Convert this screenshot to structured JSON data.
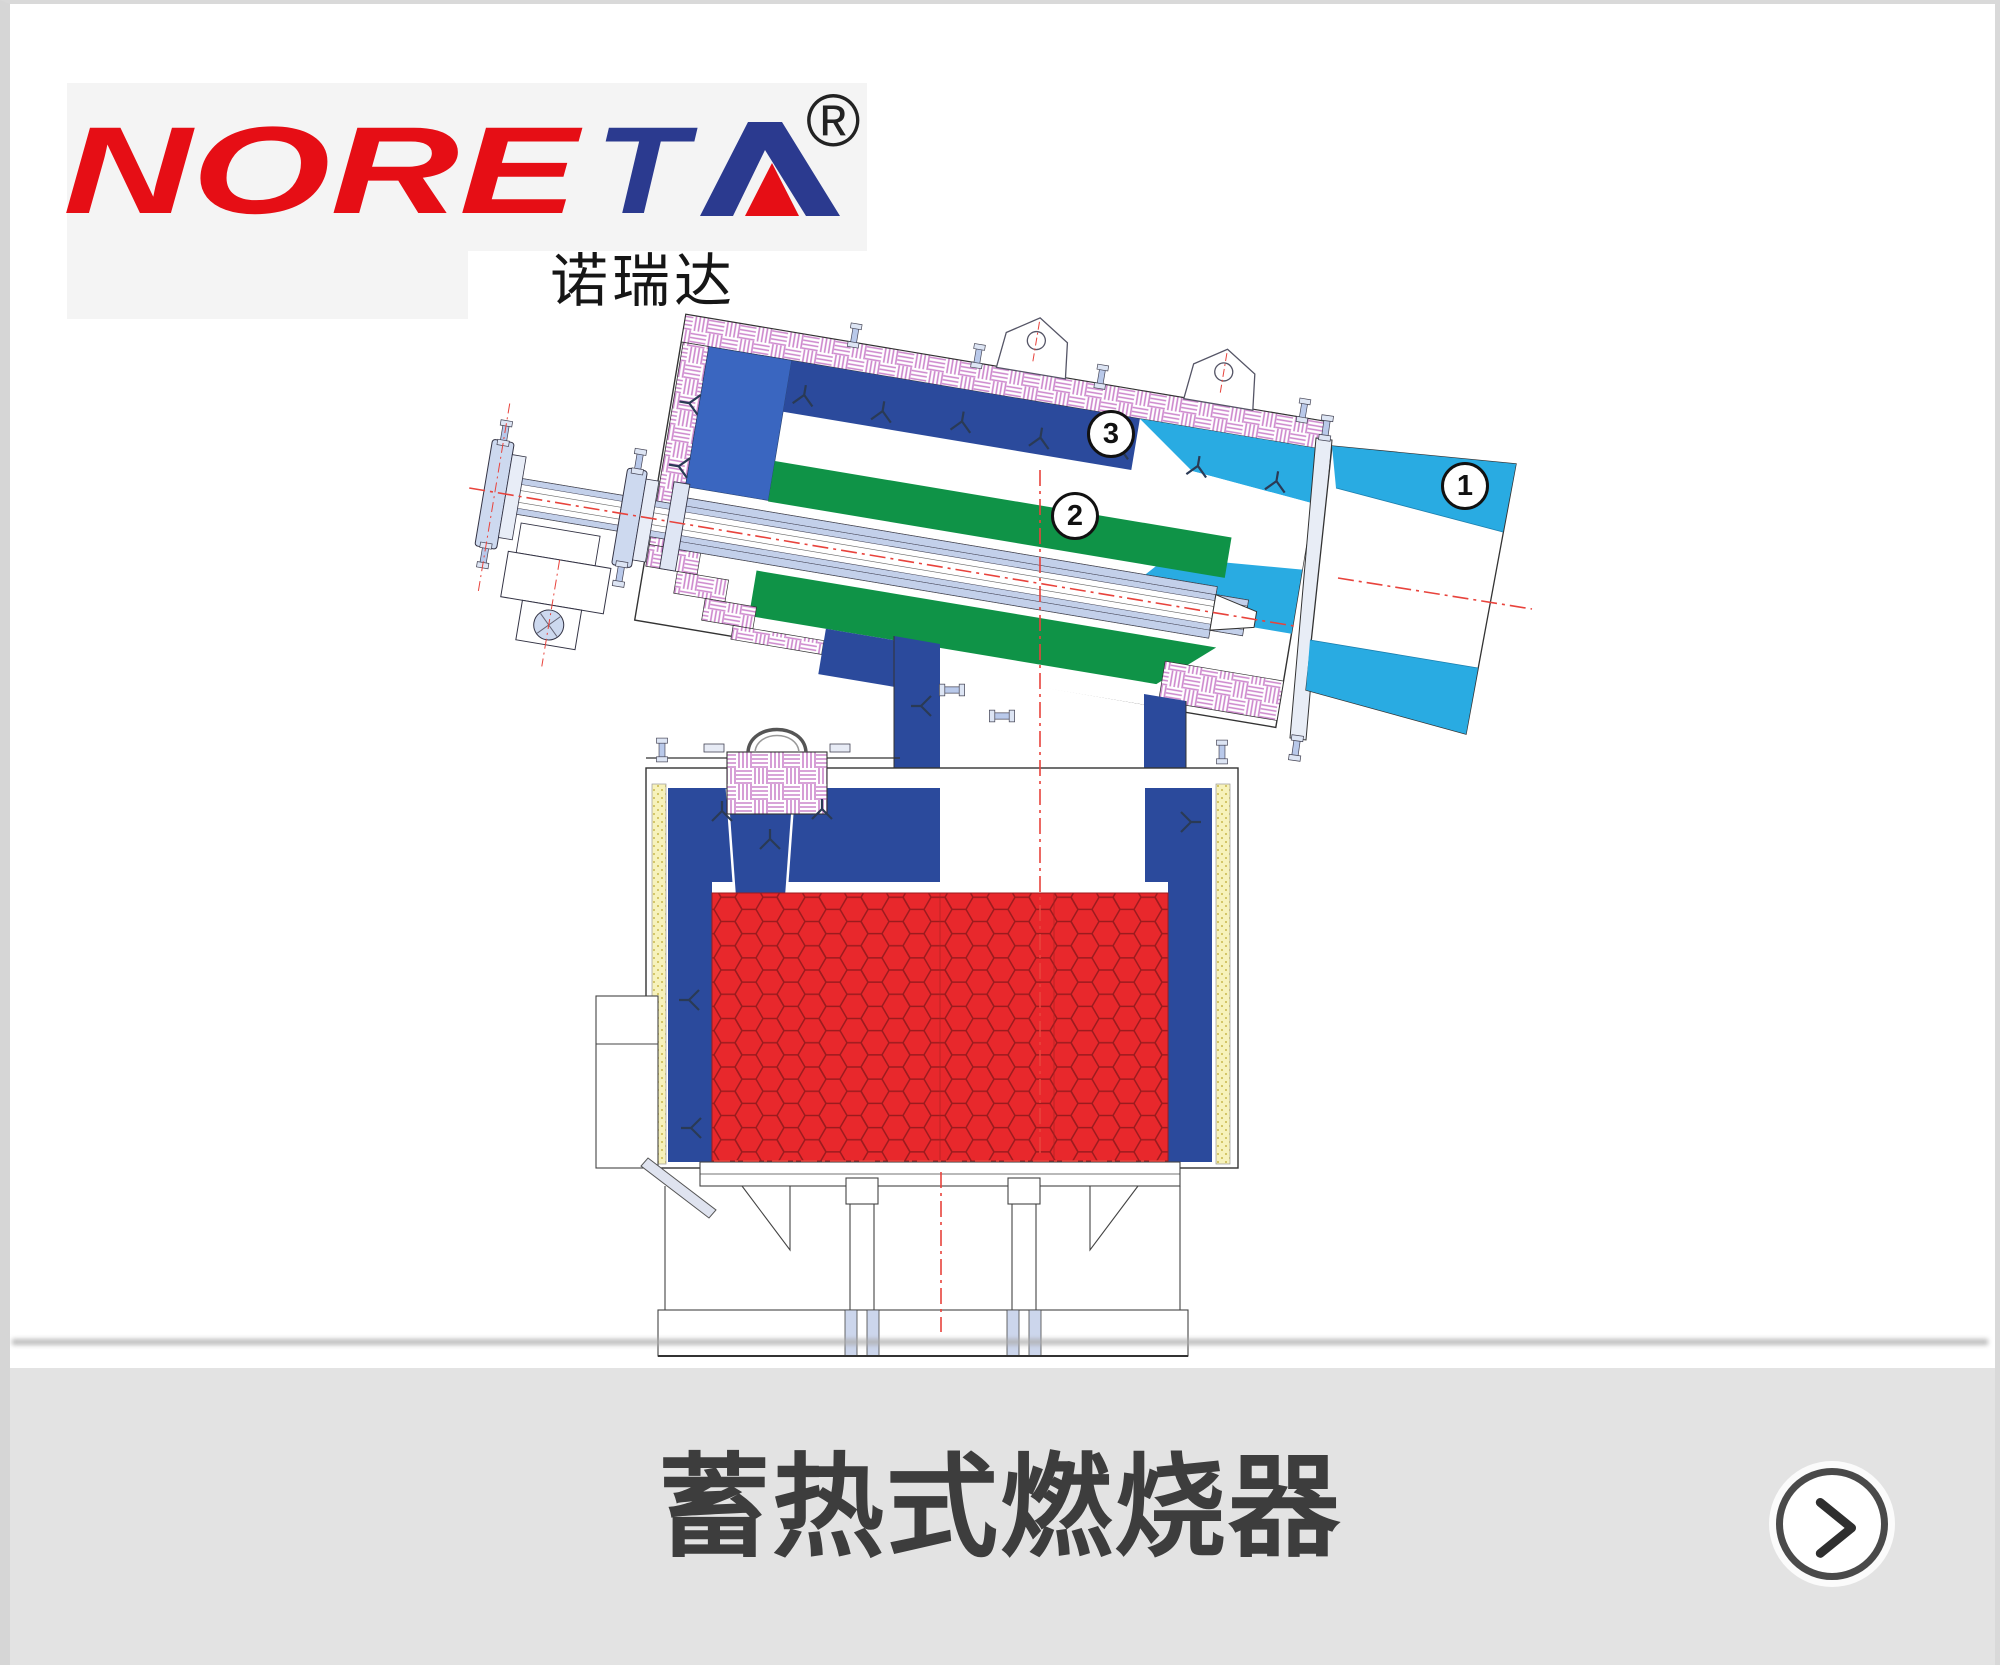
{
  "logo": {
    "wordmark_red": "NORE",
    "wordmark_blue": "T",
    "registered_mark": "®",
    "chinese_name": "诺瑞达",
    "colors": {
      "red": "#e60e15",
      "blue": "#2b3a8f",
      "panel_bg": "#f4f4f4"
    }
  },
  "diagram": {
    "part_labels": [
      {
        "number": "1"
      },
      {
        "number": "2"
      },
      {
        "number": "3"
      }
    ],
    "colors": {
      "steel_blue": "#2b4a9c",
      "medium_blue": "#3a66c0",
      "green": "#0f9347",
      "cyan": "#29abe2",
      "honeycomb_red": "#e8282c",
      "honeycomb_line": "#9c1b1e",
      "insulation_pink": "#cc85cc",
      "insulation_yellow": "#f7f2bb",
      "centerline_red": "#e8433c"
    }
  },
  "footer": {
    "title": "蓄热式燃烧器",
    "bar_color": "#e3e3e3",
    "title_color": "#3d3d3d"
  }
}
